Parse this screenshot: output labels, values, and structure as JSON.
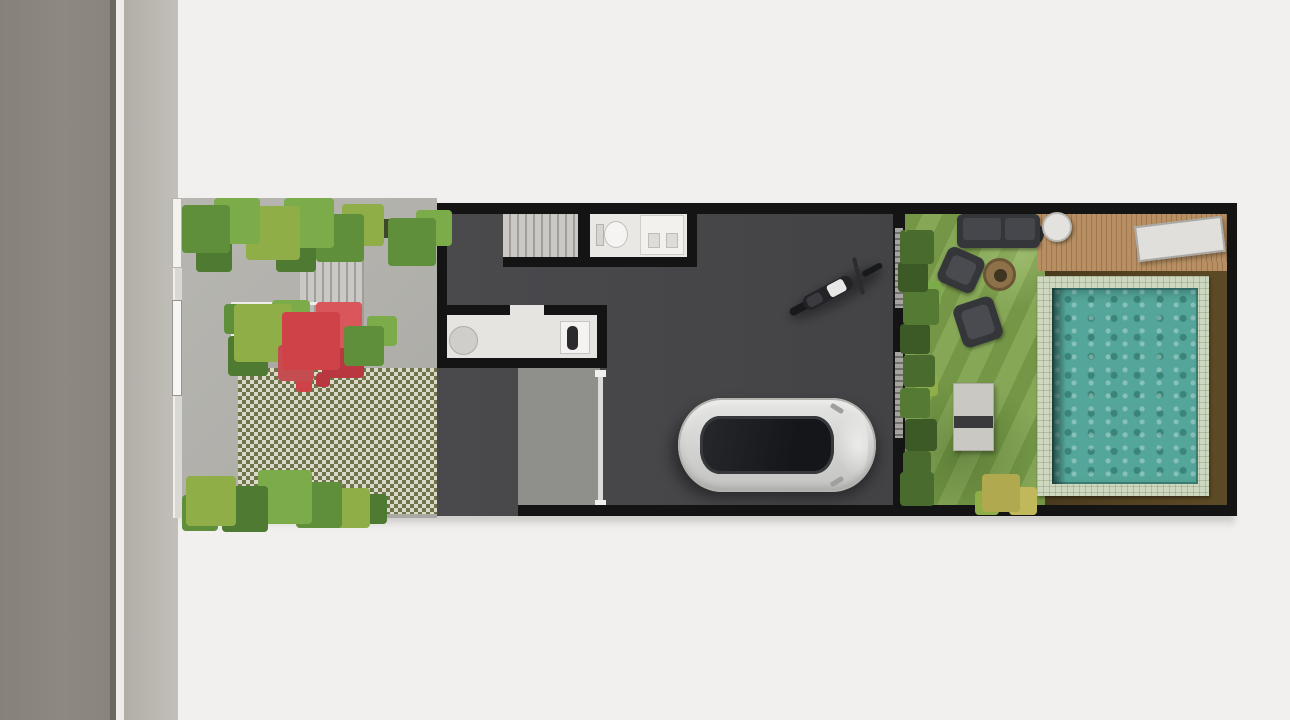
{
  "scene": {
    "type": "architectural-site-plan",
    "view": "top-down rendered floor plan of a narrow townhouse lot between street and rear pool garden",
    "sections": [
      "street",
      "sidewalk",
      "front-yard",
      "house-ground-floor",
      "carport-driveway",
      "back-garden",
      "pool-deck"
    ]
  },
  "front_yard": {
    "features": [
      "side-gate",
      "shrub-border",
      "entry-steps",
      "planter-with-red-bougainvillea",
      "palm-plants",
      "grass-block-paver-driveway",
      "fern-border",
      "trimmed-hedge"
    ]
  },
  "house": {
    "rooms": [
      {
        "name": "staircase"
      },
      {
        "name": "bathroom",
        "fixtures": [
          "toilet",
          "vanity-with-two-sinks"
        ]
      },
      {
        "name": "pantry-kitchen",
        "fixtures": [
          "round-table",
          "counter-sink"
        ]
      },
      {
        "name": "garage-hall",
        "contents": [
          "silver-car-top-view",
          "motorcycle-top-view"
        ],
        "features": [
          "roller-door-track",
          "sliding-rail-doors-to-garden"
        ]
      }
    ]
  },
  "garden": {
    "features": [
      "lawn",
      "side-hedge",
      "outdoor-sofa",
      "armchair-upper",
      "armchair-lower",
      "fire-pit",
      "garden-bench",
      "wood-deck",
      "round-side-table",
      "planter-pot",
      "sun-lounger",
      "swimming-pool",
      "pool-coping",
      "brown-pool-surround",
      "yellow-shrub"
    ]
  },
  "colors": {
    "bg": "#f1f0ee",
    "road": "#8e8882",
    "road-edge": "#6b6660",
    "curb": "#edece9",
    "sidewalk": "#c2bfb9",
    "paving": "#b0afaa",
    "wall": "#141414",
    "floor": "#434346",
    "apron": "#8f8f8b",
    "checker-olive": "#6f734a",
    "checker-light": "#dad9ca",
    "stair": "#c9c8c4",
    "stair-line": "#a19e9a",
    "bath": "#eae8e4",
    "kitchen": "#e6e4e0",
    "grass": "#7ea24c",
    "hedge": "#4a6b2e",
    "deck": "#b78f62",
    "deck-line": "#9d774f",
    "pool-tile": "#ced7bf",
    "pool-water": "#55a69a",
    "pool-brown": "#5d4a26",
    "furniture": "#35363a",
    "bench": "#c9c8c3",
    "car-body": "#d2d2d0",
    "car-glass": "#141619",
    "moto": "#18191b",
    "red-bush": "#cf4348"
  }
}
